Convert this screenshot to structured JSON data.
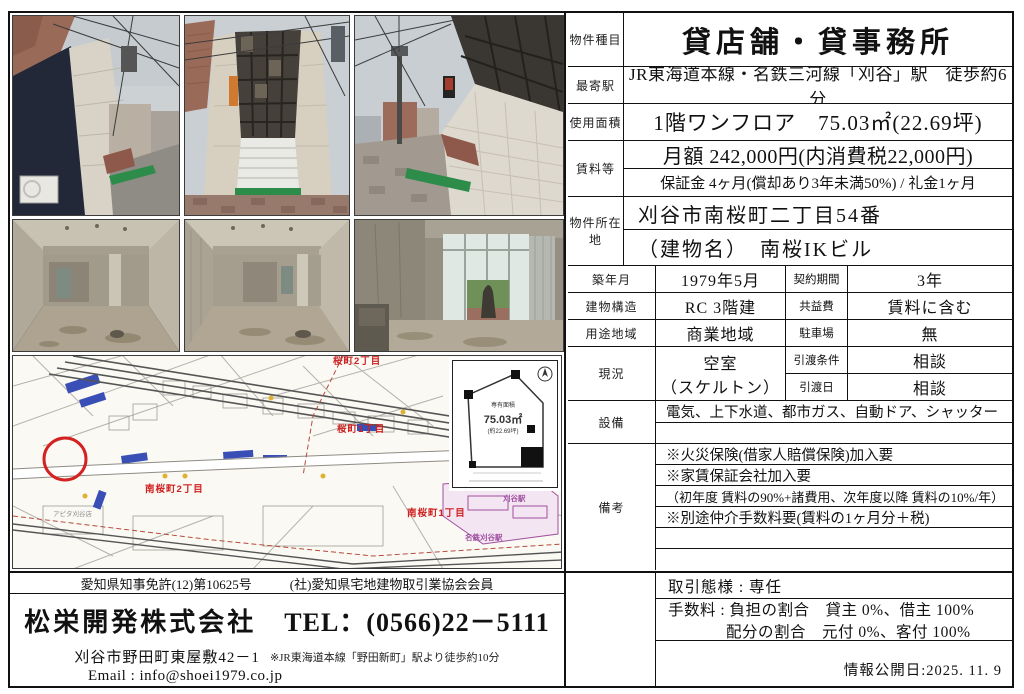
{
  "table": {
    "type": {
      "label": "物件種目",
      "value": "貸店舗・貸事務所"
    },
    "station": {
      "label": "最寄駅",
      "value": "JR東海道本線・名鉄三河線「刈谷」駅　徒歩約6分"
    },
    "area": {
      "label": "使用面積",
      "value": "1階ワンフロア　75.03㎡(22.69坪)"
    },
    "rent": {
      "label": "賃料等",
      "line1": "月額 242,000円(内消費税22,000円)",
      "line2": "保証金 4ヶ月(償却あり3年未満50%) / 礼金1ヶ月"
    },
    "location": {
      "label": "物件所在地",
      "line1": "刈谷市南桜町二丁目54番",
      "line2": "（建物名）　南桜IKビル"
    },
    "built": {
      "label": "築年月",
      "value": "1979年5月"
    },
    "contract": {
      "label": "契約期間",
      "value": "3年"
    },
    "structure": {
      "label": "建物構造",
      "value": "RC 3階建"
    },
    "service_fee": {
      "label": "共益費",
      "value": "賃料に含む"
    },
    "zoning": {
      "label": "用途地域",
      "value": "商業地域"
    },
    "parking": {
      "label": "駐車場",
      "value": "無"
    },
    "status": {
      "label": "現況",
      "line1": "空室",
      "line2": "（スケルトン）"
    },
    "handover_cond": {
      "label": "引渡条件",
      "value": "相談"
    },
    "handover_date": {
      "label": "引渡日",
      "value": "相談"
    },
    "equipment": {
      "label": "設備",
      "value": "電気、上下水道、都市ガス、自動ドア、シャッター"
    },
    "notes": {
      "label": "備考",
      "items": [
        "※火災保険(借家人賠償保険)加入要",
        "※家賃保証会社加入要",
        "（初年度 賃料の90%+諸費用、次年度以降 賃料の10%/年）",
        "※別途仲介手数料要(賃料の1ヶ月分＋税)"
      ]
    }
  },
  "floorplan": {
    "area_label": "専有面積",
    "sqm": "75.03㎡",
    "tsubo": "(約22.69坪)"
  },
  "map": {
    "labels": {
      "sakura2": "桜町2丁目",
      "sakura1": "桜町1丁目",
      "minamisakura2": "南桜町2丁目",
      "minamisakura1": "南桜町1丁目",
      "station": "刈谷駅",
      "station2": "名鉄刈谷駅",
      "store": "アピタ刈谷店"
    },
    "marker_color": "#d42222"
  },
  "footer": {
    "left": {
      "license": "愛知県知事免許(12)第10625号",
      "association": "(社)愛知県宅地建物取引業協会会員",
      "company": "松栄開発株式会社",
      "tel": "TEL：(0566)22－5111",
      "address": "刈谷市野田町東屋敷42－1",
      "address_note": "※JR東海道本線「野田新町」駅より徒歩約10分",
      "email": "Email : info@shoei1979.co.jp"
    },
    "right": {
      "deal_type": "取引態様 : 専任",
      "commission1": "手数料 : 負担の割合　貸主 0%、借主 100%",
      "commission2": "配分の割合　元付 0%、客付 100%",
      "published": "情報公開日:2025. 11. 9"
    }
  }
}
